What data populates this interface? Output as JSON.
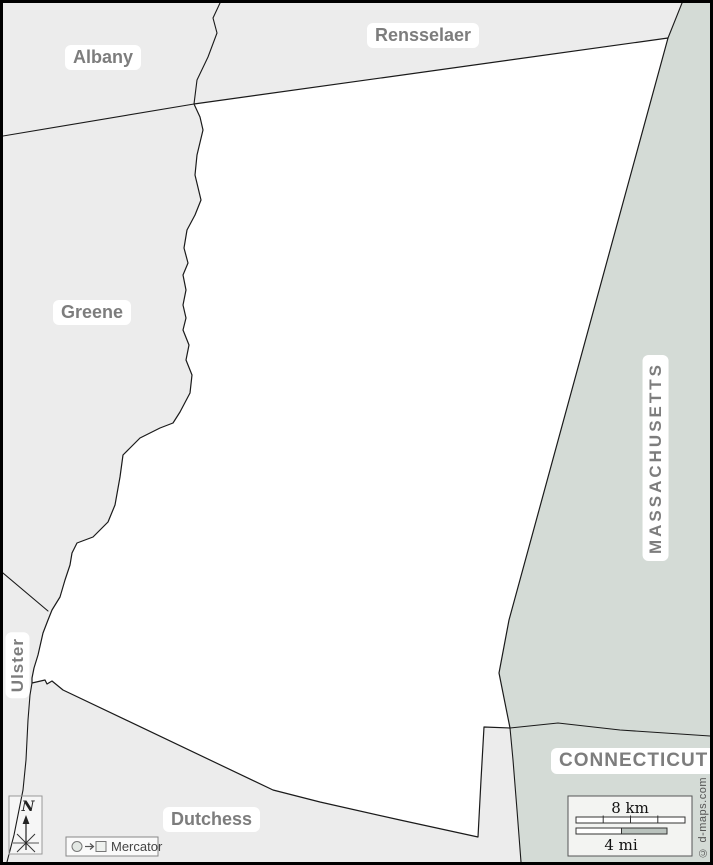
{
  "regions": {
    "albany": "Albany",
    "rensselaer": "Rensselaer",
    "greene": "Greene",
    "ulster": "Ulster",
    "dutchess": "Dutchess",
    "massachusetts": "MASSACHUSETTS",
    "connecticut": "CONNECTICUT"
  },
  "scale": {
    "km": "8 km",
    "mi": "4 mi"
  },
  "compass": {
    "north": "N"
  },
  "projection": {
    "name": "Mercator"
  },
  "attribution": {
    "text": "© d-maps.com"
  },
  "colors": {
    "neighbor_county_fill": "#ececec",
    "state_fill": "#d4dbd6",
    "focus_county_fill": "#ffffff",
    "boundary_line": "#1a1a1a",
    "label_text": "#7d7d7d",
    "frame": "#000000"
  }
}
